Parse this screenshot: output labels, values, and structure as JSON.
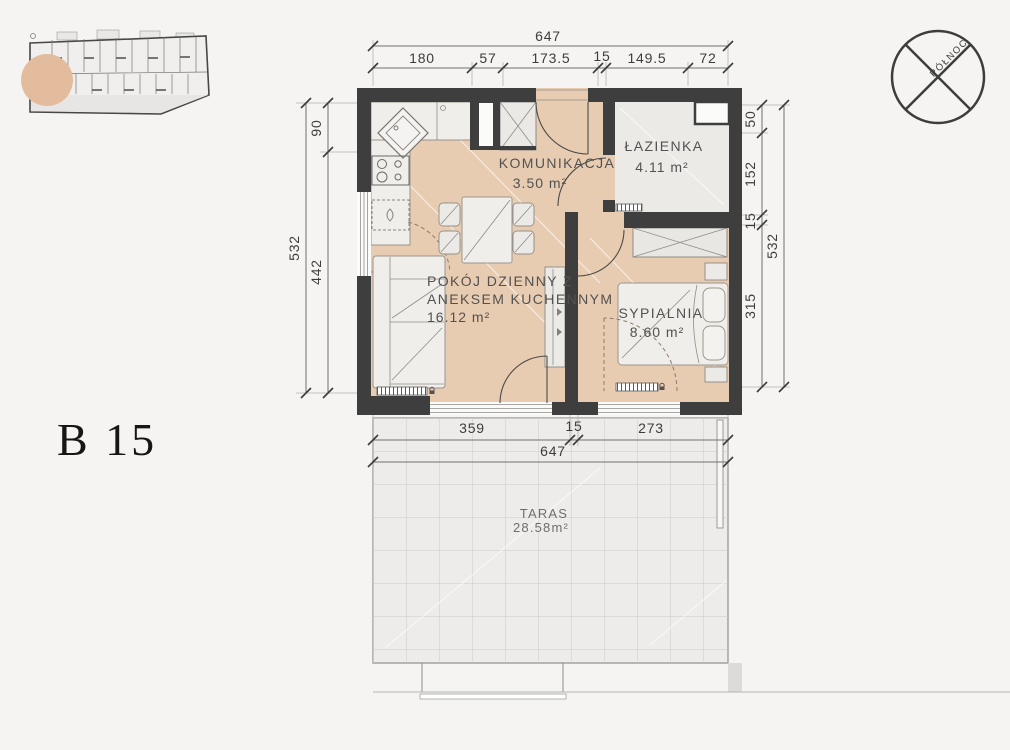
{
  "page": {
    "background": "#f5f4f2"
  },
  "unit_label": "B 15",
  "compass": {
    "label": "PÓŁNOC"
  },
  "rooms": {
    "hall": {
      "name": "KOMUNIKACJA",
      "area": "3.50 m²"
    },
    "bathroom": {
      "name": "ŁAZIENKA",
      "area": "4.11 m²"
    },
    "living": {
      "name_line1": "POKÓJ DZIENNY Z",
      "name_line2": "ANEKSEM KUCHENNYM",
      "area": "16.12 m²"
    },
    "bedroom": {
      "name": "SYPIALNIA",
      "area": "8.60 m²"
    },
    "terrace": {
      "name": "TARAS",
      "area": "28.58m²"
    }
  },
  "dimensions": {
    "top_total": "647",
    "top_segments": [
      "180",
      "57",
      "173.5",
      "15",
      "149.5",
      "72"
    ],
    "left_total": "532",
    "left_segments": [
      "90",
      "442"
    ],
    "right_segments": [
      "50",
      "152",
      "15",
      "315"
    ],
    "right_total": "532",
    "bottom_segments": [
      "359",
      "15",
      "273"
    ],
    "bottom_total": "647"
  },
  "colors": {
    "floor_beige": "#e8ccb2",
    "wall_dark": "#3e3e3e",
    "bathroom_floor": "#ebeae6",
    "highlight_circle": "#e2bc9d"
  }
}
